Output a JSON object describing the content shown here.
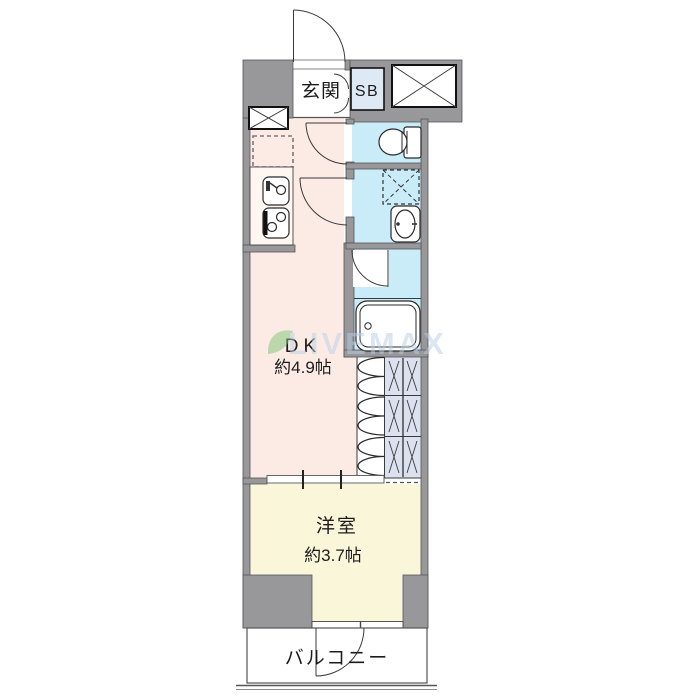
{
  "floorplan": {
    "labels": {
      "genkan": "玄関",
      "shoe_box": "SB",
      "dk_name": "DK",
      "dk_size": "約4.9帖",
      "western_room_name": "洋室",
      "western_room_size": "約3.7帖",
      "balcony": "バルコニー"
    },
    "watermark": "LIVEMAX",
    "colors": {
      "wall": "#98989a",
      "dk_floor": "#fcebe5",
      "wet_area_floor": "#c9ecf8",
      "shoe_box_fill": "#dde9f4",
      "closet_fill": "#dce1f0",
      "western_room_floor": "#faf6da",
      "genkan_floor": "#ffffff",
      "balcony_floor": "#ffffff",
      "watermark_blue": "#b9cfe7",
      "watermark_green": "#7fc474"
    }
  }
}
